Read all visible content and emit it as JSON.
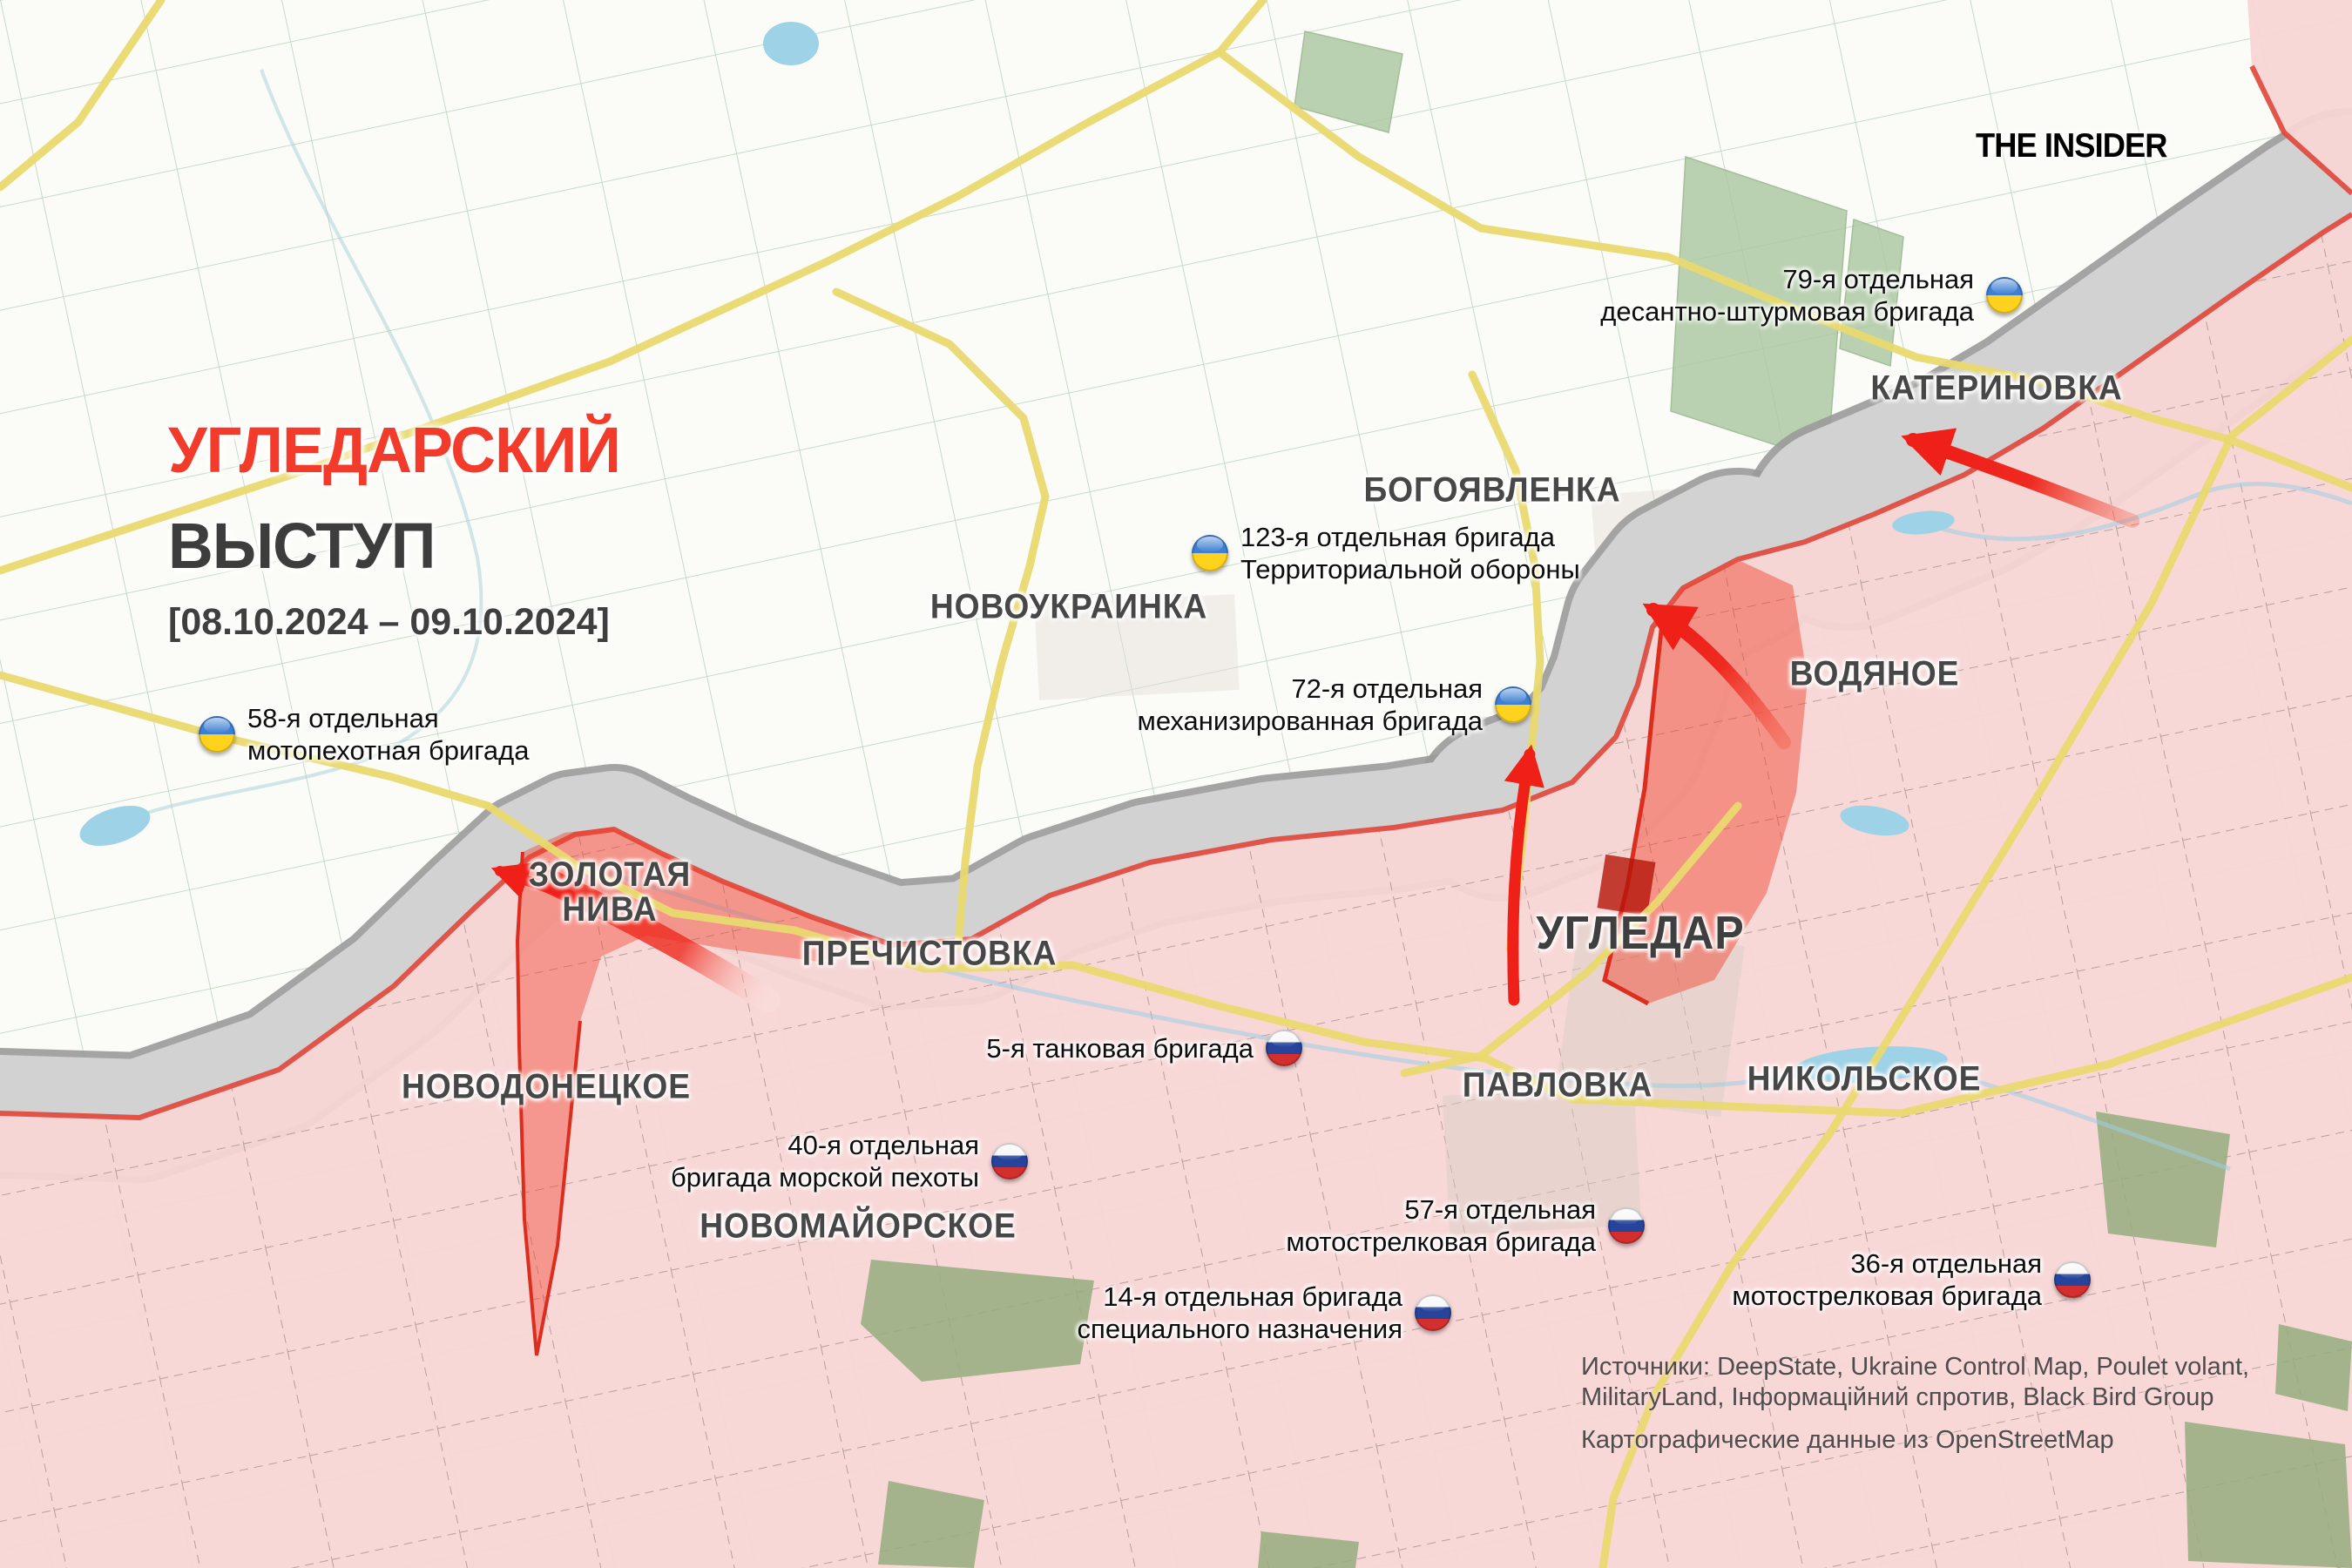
{
  "header": {
    "logo": "THE INSIDER"
  },
  "title": {
    "line1": "УГЛЕДАРСКИЙ",
    "line2": "ВЫСТУП",
    "dates": "[08.10.2024 – 09.10.2024]"
  },
  "cities": [
    {
      "id": "katerynivka",
      "name": "КАТЕРИНОВКА"
    },
    {
      "id": "bogoyavlenka",
      "name": "БОГОЯВЛЕНКА"
    },
    {
      "id": "novoukrainka",
      "name": "НОВОУКРАИНКА"
    },
    {
      "id": "vodiane",
      "name": "ВОДЯНОЕ"
    },
    {
      "id": "vuhledar",
      "name": "УГЛЕДАР"
    },
    {
      "id": "zolota-nyva",
      "name": "ЗОЛОТАЯ НИВА"
    },
    {
      "id": "prechystivka",
      "name": "ПРЕЧИСТОВКА"
    },
    {
      "id": "novodonetske",
      "name": "НОВОДОНЕЦКОЕ"
    },
    {
      "id": "novomaiorske",
      "name": "НОВОМАЙОРСКОЕ"
    },
    {
      "id": "pavlivka",
      "name": "ПАВЛОВКА"
    },
    {
      "id": "nikolske",
      "name": "НИКОЛЬСКОЕ"
    }
  ],
  "units": [
    {
      "country": "ua",
      "line1": "79-я отдельная",
      "line2": "десантно-штурмовая бригада"
    },
    {
      "country": "ua",
      "line1": "123-я отдельная бригада",
      "line2": "Территориальной обороны"
    },
    {
      "country": "ua",
      "line1": "72-я отдельная",
      "line2": "механизированная бригада"
    },
    {
      "country": "ua",
      "line1": "58-я отдельная",
      "line2": "мотопехотная бригада"
    },
    {
      "country": "ru",
      "line1": "5-я танковая бригада",
      "line2": ""
    },
    {
      "country": "ru",
      "line1": "40-я отдельная",
      "line2": "бригада морской пехоты"
    },
    {
      "country": "ru",
      "line1": "57-я отдельная",
      "line2": "мотострелковая бригада"
    },
    {
      "country": "ru",
      "line1": "36-я отдельная",
      "line2": "мотострелковая бригада"
    },
    {
      "country": "ru",
      "line1": "14-я отдельная бригада",
      "line2": "специального назначения"
    }
  ],
  "sources": {
    "line1": "Источники: DeepState, Ukraine Control Map, Poulet volant,",
    "line2": "MilitaryLand, Інформаційний спротив, Black Bird Group",
    "line3": "Картографические данные из OpenStreetMap"
  },
  "map": {
    "russian_controlled_color": "#f8d5d5",
    "contested_zone_color": "#d2d2d2",
    "frontline_color": "#e0463a",
    "advance_zone_color": "#e8392a",
    "road_color": "#e9d96f",
    "arrow_color": "#ee2018",
    "title_accent_color": "#f23b2b"
  }
}
